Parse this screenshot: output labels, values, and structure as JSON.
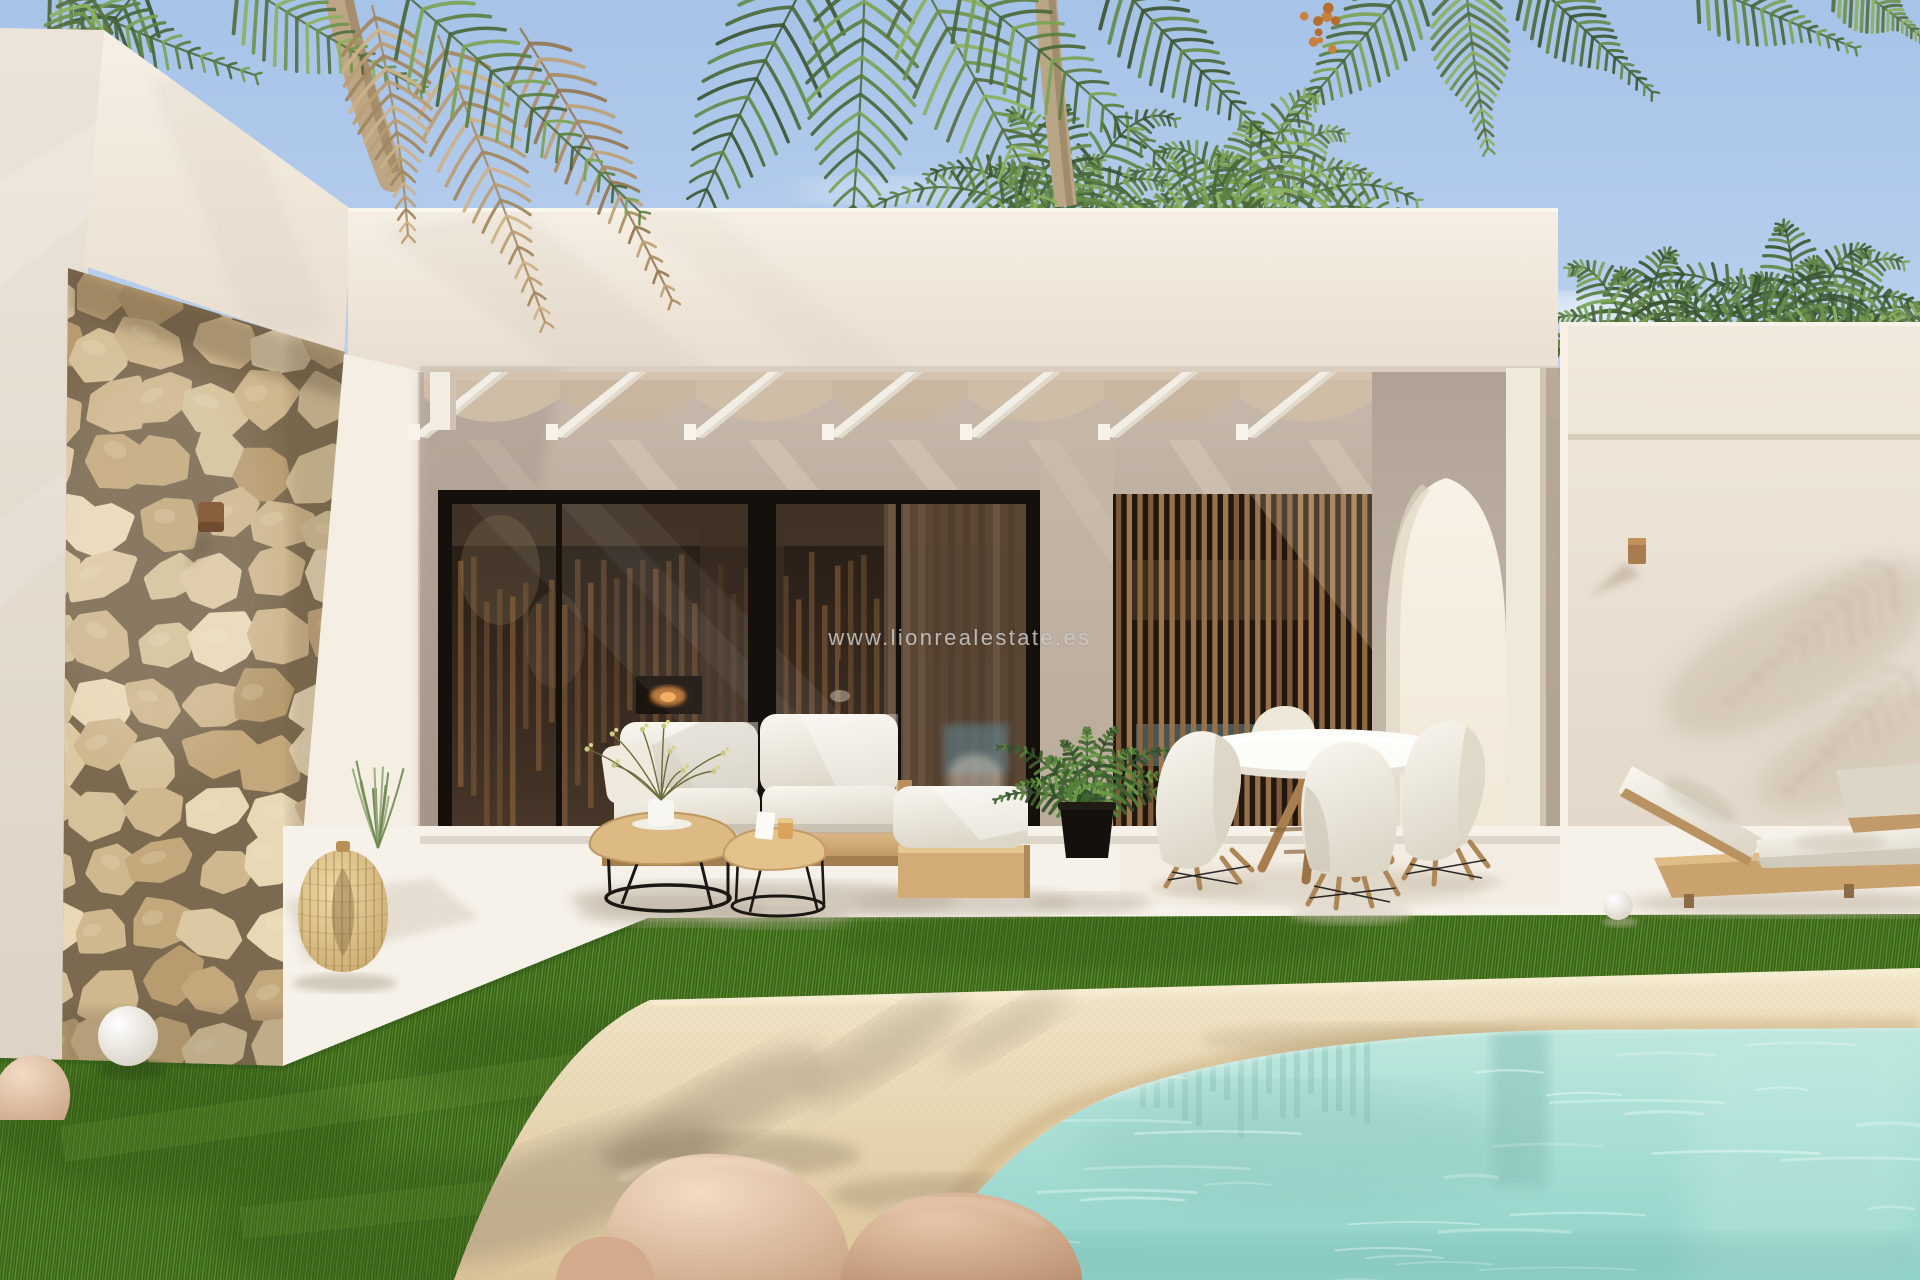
{
  "watermark": {
    "text": "www.lionrealestate.es"
  },
  "scene": {
    "colors": {
      "watermark": "#cccccc",
      "sky_top": "#a6c3e8",
      "sky_bottom": "#d6e3f5",
      "wall_light": "#f3ece1",
      "wall_side": "#e9e1d6",
      "wall_back_shade": "#b9ab9d",
      "wall_right_wing": "#ece3d6",
      "stone": "#d5c29c",
      "stone_mortar": "#7c6a50",
      "glass_dark": "#2a2018",
      "slat_wood": "#96714a",
      "arch_light": "#f6efe2",
      "floor": "#f6f1e9",
      "grass": "#47741f",
      "sand": "#e9d9b7",
      "pool": "#9fdbd2",
      "cushion": "#f3efe6",
      "wood_furniture": "#c9a06a",
      "rock": "#d9b496",
      "palm_green": "#5e8142",
      "palm_dry": "#bb9d72",
      "sconce_bronze": "#8a5f3c"
    }
  }
}
